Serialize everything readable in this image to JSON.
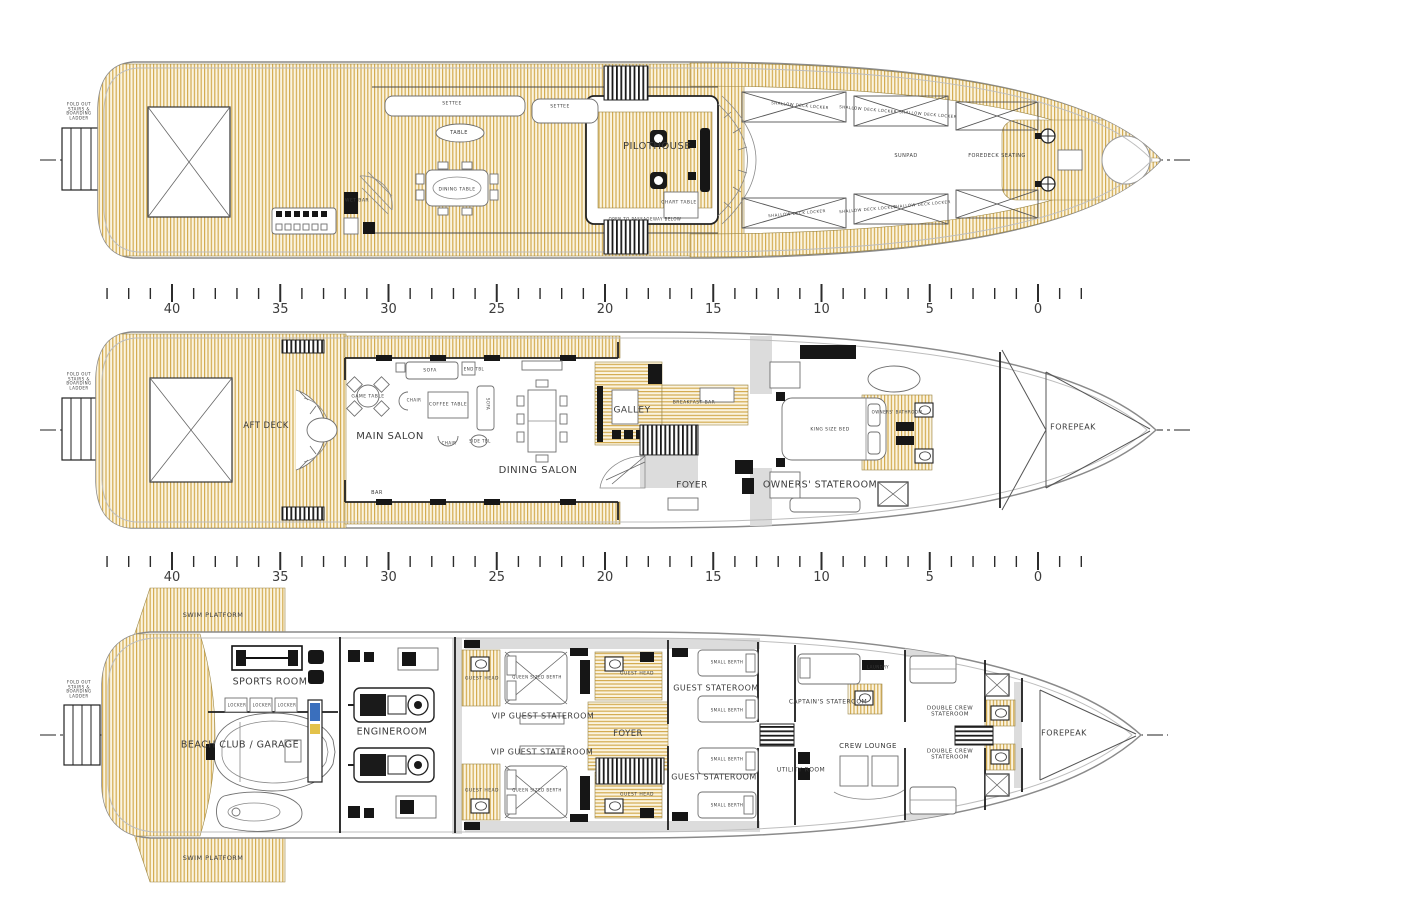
{
  "colors": {
    "teak_stripe": "#d3ab50",
    "teak_bg": "#fbf4e0",
    "line": "#3a3a3a",
    "hull_outline": "#8a8a8a",
    "bulkhead": "#222222",
    "gray_zone": "#dcdcdc",
    "tank_blue": "#3a6fbd",
    "tank_yellow": "#e3c24a"
  },
  "ruler": {
    "px_per_m": 21.65,
    "x_zero": 1038,
    "m_min": -2,
    "m_max": 43,
    "numbers": [
      "40",
      "35",
      "30",
      "25",
      "20",
      "15",
      "10",
      "5",
      "0"
    ],
    "rows": [
      {
        "tick_y": 284,
        "num_y": 302
      },
      {
        "tick_y": 552,
        "num_y": 570
      }
    ]
  },
  "decks": [
    {
      "id": "bridge-deck",
      "labels": [
        {
          "t": "FOLD OUT\nSTAIRS &\nBOARDING\nLADDER",
          "x": 79,
          "y": 112,
          "s": 4
        },
        {
          "t": "SETTEE",
          "x": 452,
          "y": 104,
          "s": 4.5
        },
        {
          "t": "SETTEE",
          "x": 560,
          "y": 107,
          "s": 4.5
        },
        {
          "t": "TABLE",
          "x": 459,
          "y": 134,
          "s": 5
        },
        {
          "t": "WET BAR",
          "x": 357,
          "y": 201,
          "s": 4.5
        },
        {
          "t": "DINING TABLE",
          "x": 457,
          "y": 190,
          "s": 4.5
        },
        {
          "t": "PILOTHOUSE",
          "x": 657,
          "y": 147,
          "s": 10
        },
        {
          "t": "CHART TABLE",
          "x": 679,
          "y": 203,
          "s": 4.5
        },
        {
          "t": "OPEN TO PASSAGEWAY BELOW",
          "x": 645,
          "y": 220,
          "s": 4
        },
        {
          "t": "SUNPAD",
          "x": 906,
          "y": 157,
          "s": 5
        },
        {
          "t": "FOREDECK SEATING",
          "x": 997,
          "y": 157,
          "s": 5
        },
        {
          "t": "SHALLOW DECK LOCKER",
          "x": 800,
          "y": 106,
          "s": 4,
          "r": 5
        },
        {
          "t": "SHALLOW DECK LOCKER",
          "x": 868,
          "y": 110,
          "s": 4,
          "r": 5
        },
        {
          "t": "SHALLOW DECK LOCKER",
          "x": 928,
          "y": 115,
          "s": 4,
          "r": 5
        },
        {
          "t": "SHALLOW DECK LOCKER",
          "x": 797,
          "y": 214,
          "s": 4,
          "r": -5
        },
        {
          "t": "SHALLOW DECK LOCKER",
          "x": 868,
          "y": 210,
          "s": 4,
          "r": -5
        },
        {
          "t": "SHALLOW DECK LOCKER",
          "x": 922,
          "y": 205,
          "s": 4,
          "r": -5
        }
      ]
    },
    {
      "id": "main-deck",
      "labels": [
        {
          "t": "FOLD OUT\nSTAIRS &\nBOARDING\nLADDER",
          "x": 79,
          "y": 382,
          "s": 4
        },
        {
          "t": "AFT DECK",
          "x": 266,
          "y": 426,
          "s": 8.5
        },
        {
          "t": "MAIN SALON",
          "x": 390,
          "y": 437,
          "s": 10
        },
        {
          "t": "GAME TABLE",
          "x": 368,
          "y": 397,
          "s": 4.5
        },
        {
          "t": "SOFA",
          "x": 430,
          "y": 371,
          "s": 4.5
        },
        {
          "t": "END TBL",
          "x": 474,
          "y": 370,
          "s": 4
        },
        {
          "t": "COFFEE TABLE",
          "x": 448,
          "y": 405,
          "s": 4.5
        },
        {
          "t": "CHAIR",
          "x": 414,
          "y": 401,
          "s": 4
        },
        {
          "t": "CHAIR",
          "x": 449,
          "y": 444,
          "s": 4
        },
        {
          "t": "SOFA",
          "x": 487,
          "y": 404,
          "s": 4,
          "r": 90
        },
        {
          "t": "SIDE TBL",
          "x": 480,
          "y": 442,
          "s": 4
        },
        {
          "t": "BAR",
          "x": 377,
          "y": 494,
          "s": 5
        },
        {
          "t": "DINING SALON",
          "x": 538,
          "y": 471,
          "s": 10
        },
        {
          "t": "GALLEY",
          "x": 632,
          "y": 411,
          "s": 9
        },
        {
          "t": "BREAKFAST BAR",
          "x": 694,
          "y": 403,
          "s": 4.5
        },
        {
          "t": "FOYER",
          "x": 692,
          "y": 486,
          "s": 9
        },
        {
          "t": "OWNERS' STATEROOM",
          "x": 820,
          "y": 485,
          "s": 9.5
        },
        {
          "t": "KING SIZE BED",
          "x": 830,
          "y": 430,
          "s": 4.5
        },
        {
          "t": "OWNERS' BATHROOM",
          "x": 897,
          "y": 413,
          "s": 4
        },
        {
          "t": "FOREPEAK",
          "x": 1073,
          "y": 427,
          "s": 8
        }
      ]
    },
    {
      "id": "lower-deck",
      "labels": [
        {
          "t": "FOLD OUT\nSTAIRS &\nBOARDING\nLADDER",
          "x": 79,
          "y": 690,
          "s": 4
        },
        {
          "t": "SWIM PLATFORM",
          "x": 213,
          "y": 616,
          "s": 6.5
        },
        {
          "t": "SWIM PLATFORM",
          "x": 213,
          "y": 859,
          "s": 6.5
        },
        {
          "t": "SPORTS ROOM",
          "x": 270,
          "y": 682,
          "s": 9.5
        },
        {
          "t": "LOCKER",
          "x": 237,
          "y": 706,
          "s": 4
        },
        {
          "t": "LOCKER",
          "x": 262,
          "y": 706,
          "s": 4
        },
        {
          "t": "LOCKER",
          "x": 287,
          "y": 706,
          "s": 4
        },
        {
          "t": "BEACH CLUB / GARAGE",
          "x": 240,
          "y": 745,
          "s": 9.5
        },
        {
          "t": "ENGINEROOM",
          "x": 392,
          "y": 732,
          "s": 9.5
        },
        {
          "t": "VIP GUEST STATEROOM",
          "x": 543,
          "y": 716,
          "s": 8
        },
        {
          "t": "VIP GUEST STATEROOM",
          "x": 542,
          "y": 752,
          "s": 8
        },
        {
          "t": "GUEST HEAD",
          "x": 482,
          "y": 679,
          "s": 4.5
        },
        {
          "t": "GUEST HEAD",
          "x": 482,
          "y": 791,
          "s": 4.5
        },
        {
          "t": "GUEST HEAD",
          "x": 637,
          "y": 674,
          "s": 4.5
        },
        {
          "t": "GUEST HEAD",
          "x": 637,
          "y": 795,
          "s": 4.5
        },
        {
          "t": "QUEEN SIZED BERTH",
          "x": 537,
          "y": 678,
          "s": 4
        },
        {
          "t": "QUEEN SIZED BERTH",
          "x": 537,
          "y": 791,
          "s": 4
        },
        {
          "t": "FOYER",
          "x": 628,
          "y": 734,
          "s": 8.5
        },
        {
          "t": "GUEST STATEROOM",
          "x": 716,
          "y": 688,
          "s": 8
        },
        {
          "t": "GUEST STATEROOM",
          "x": 714,
          "y": 777,
          "s": 8
        },
        {
          "t": "SMALL BERTH",
          "x": 727,
          "y": 663,
          "s": 4
        },
        {
          "t": "SMALL BERTH",
          "x": 727,
          "y": 711,
          "s": 4
        },
        {
          "t": "SMALL BERTH",
          "x": 727,
          "y": 760,
          "s": 4
        },
        {
          "t": "SMALL BERTH",
          "x": 727,
          "y": 806,
          "s": 4
        },
        {
          "t": "CAPTAIN'S STATEROOM",
          "x": 828,
          "y": 702,
          "s": 6
        },
        {
          "t": "LAUNDRY",
          "x": 878,
          "y": 668,
          "s": 4
        },
        {
          "t": "CREW LOUNGE",
          "x": 868,
          "y": 746,
          "s": 7
        },
        {
          "t": "UTILITY ROOM",
          "x": 801,
          "y": 770,
          "s": 6
        },
        {
          "t": "DOUBLE CREW\nSTATEROOM",
          "x": 950,
          "y": 712,
          "s": 5.5
        },
        {
          "t": "DOUBLE CREW\nSTATEROOM",
          "x": 950,
          "y": 755,
          "s": 5.5
        },
        {
          "t": "FOREPEAK",
          "x": 1064,
          "y": 733,
          "s": 8
        }
      ]
    }
  ]
}
